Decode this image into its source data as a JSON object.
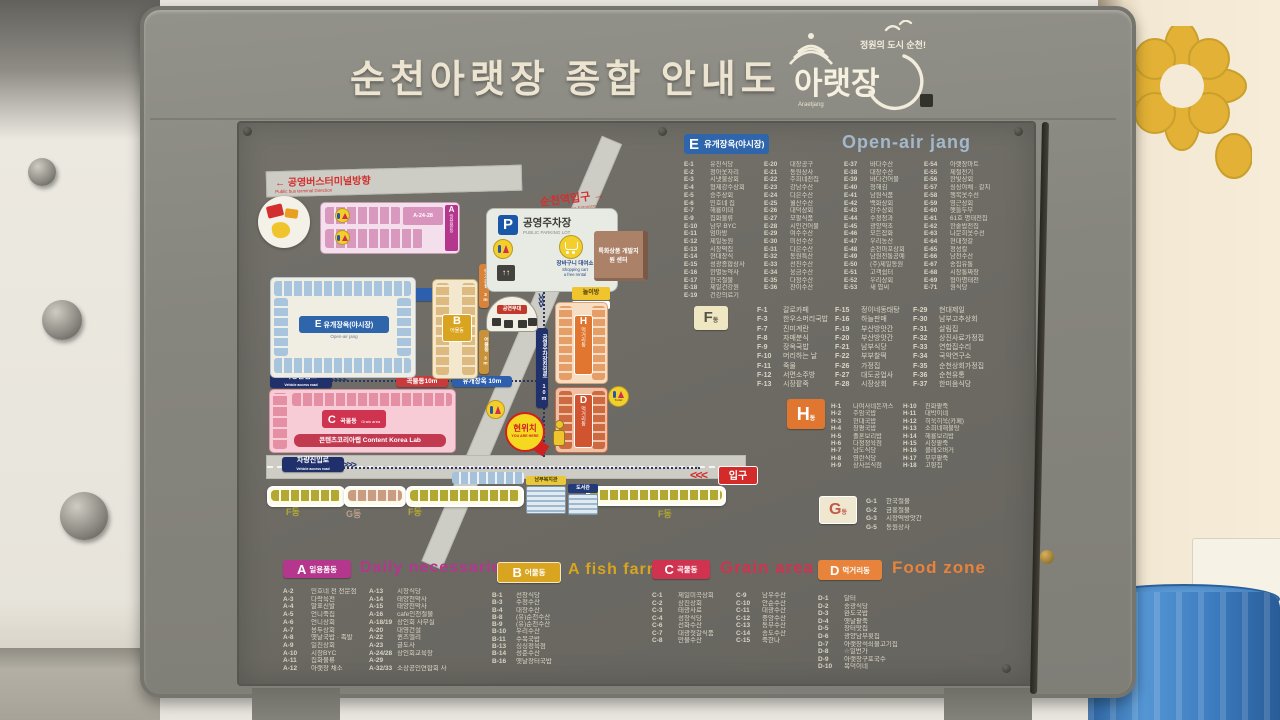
{
  "palette": {
    "board_gray": "#87867e",
    "panel_gray": "#6c6a63",
    "list_text": "#d9d4c5",
    "accent_E": "#2f66ab",
    "accent_A": "#b5368d",
    "accent_B": "#d9a520",
    "accent_C": "#cf3350",
    "accent_D": "#e8833c",
    "accent_H": "#e0762f",
    "road_gray": "#cdccc5",
    "entrance_red": "#d42a2a",
    "here_yellow": "#f5d820"
  },
  "sign": {
    "title": "순천아랫장  종합 안내도",
    "logo_tagline": "정원의 도시 순천!",
    "logo_name": "아랫장",
    "logo_latin": "Araetjang"
  },
  "legend": {
    "E": {
      "letter": "E",
      "kr": "유개장옥(야시장)",
      "en": "Open-air jang",
      "columns": [
        [
          {
            "id": "E-1",
            "name": "유진식당"
          },
          {
            "id": "E-2",
            "name": "정아옷자리"
          },
          {
            "id": "E-3",
            "name": "시냇물상회"
          },
          {
            "id": "E-4",
            "name": "형제강수상회"
          },
          {
            "id": "E-5",
            "name": "승주상회"
          },
          {
            "id": "E-6",
            "name": "민호네 집"
          },
          {
            "id": "E-7",
            "name": "해룡이대"
          },
          {
            "id": "E-9",
            "name": "집화물류"
          },
          {
            "id": "E-10",
            "name": "남부 BYC"
          },
          {
            "id": "E-11",
            "name": "엄마방"
          },
          {
            "id": "E-12",
            "name": "제일농원"
          },
          {
            "id": "E-13",
            "name": "시장떡집"
          },
          {
            "id": "E-14",
            "name": "현대장식"
          },
          {
            "id": "E-15",
            "name": "성광종합상사"
          },
          {
            "id": "E-16",
            "name": "한별농약사"
          },
          {
            "id": "E-17",
            "name": "한국철물"
          },
          {
            "id": "E-18",
            "name": "제일건강원"
          },
          {
            "id": "E-19",
            "name": "건강의료기"
          }
        ],
        [
          {
            "id": "E-20",
            "name": "대장공구"
          },
          {
            "id": "E-21",
            "name": "동원상사"
          },
          {
            "id": "E-22",
            "name": "주희네전집"
          },
          {
            "id": "E-23",
            "name": "강남수산"
          },
          {
            "id": "E-24",
            "name": "다은수산"
          },
          {
            "id": "E-25",
            "name": "월산수산"
          },
          {
            "id": "E-26",
            "name": "대덕상회"
          },
          {
            "id": "E-27",
            "name": "모팔식품"
          },
          {
            "id": "E-28",
            "name": "시인건어물"
          },
          {
            "id": "E-29",
            "name": "여수수산"
          },
          {
            "id": "E-30",
            "name": "미선수산"
          },
          {
            "id": "E-31",
            "name": "다은수산"
          },
          {
            "id": "E-32",
            "name": "동원특산"
          },
          {
            "id": "E-33",
            "name": "선진수산"
          },
          {
            "id": "E-34",
            "name": "웅금수산"
          },
          {
            "id": "E-35",
            "name": "다정수산"
          },
          {
            "id": "E-36",
            "name": "찬이수산"
          }
        ],
        [
          {
            "id": "E-37",
            "name": "바다수산"
          },
          {
            "id": "E-38",
            "name": "대장수산"
          },
          {
            "id": "E-39",
            "name": "바다건어물"
          },
          {
            "id": "E-40",
            "name": "청해김"
          },
          {
            "id": "E-41",
            "name": "남원식품"
          },
          {
            "id": "E-42",
            "name": "백화상회"
          },
          {
            "id": "E-43",
            "name": "강수상회"
          },
          {
            "id": "E-44",
            "name": "수정청과"
          },
          {
            "id": "E-45",
            "name": "광양약초"
          },
          {
            "id": "E-46",
            "name": "모든잡화"
          },
          {
            "id": "E-47",
            "name": "우리농산"
          },
          {
            "id": "E-48",
            "name": "순천마포상회"
          },
          {
            "id": "E-49",
            "name": "남원전통공예"
          },
          {
            "id": "E-50",
            "name": "(주)제일동원"
          },
          {
            "id": "E-51",
            "name": "고객쉼터"
          },
          {
            "id": "E-52",
            "name": "우리상회"
          },
          {
            "id": "E-53",
            "name": "새 엽씨"
          }
        ],
        [
          {
            "id": "E-54",
            "name": "아랫장마트"
          },
          {
            "id": "E-55",
            "name": "제철전기"
          },
          {
            "id": "E-56",
            "name": "한빛상회"
          },
          {
            "id": "E-57",
            "name": "싱싱야채 · 갈치"
          },
          {
            "id": "E-58",
            "name": "행복옷수선"
          },
          {
            "id": "E-59",
            "name": "영근상회"
          },
          {
            "id": "E-60",
            "name": "햇들두부"
          },
          {
            "id": "E-61",
            "name": "61호 명태전집"
          },
          {
            "id": "E-62",
            "name": "한솥밥전집"
          },
          {
            "id": "E-63",
            "name": "나문희옷수선"
          },
          {
            "id": "E-64",
            "name": "현대젓갈"
          },
          {
            "id": "E-65",
            "name": "정성칼"
          },
          {
            "id": "E-66",
            "name": "남천수산"
          },
          {
            "id": "E-67",
            "name": "송집유통"
          },
          {
            "id": "E-68",
            "name": "시장통짜장"
          },
          {
            "id": "E-69",
            "name": "형아명태전"
          },
          {
            "id": "E-71",
            "name": "원식당"
          }
        ]
      ]
    },
    "F": {
      "letter": "F",
      "suffix": "동",
      "columns": [
        [
          {
            "id": "F-1",
            "name": "갈로카페"
          },
          {
            "id": "F-3",
            "name": "한우소머리국밥"
          },
          {
            "id": "F-7",
            "name": "진미계란"
          },
          {
            "id": "F-8",
            "name": "자매분식"
          },
          {
            "id": "F-9",
            "name": "장옥국밥"
          },
          {
            "id": "F-10",
            "name": "머리하는 날"
          },
          {
            "id": "F-11",
            "name": "죽물"
          },
          {
            "id": "F-12",
            "name": "서면소주방"
          },
          {
            "id": "F-13",
            "name": "시장팥죽"
          }
        ],
        [
          {
            "id": "F-15",
            "name": "정이네동태탕"
          },
          {
            "id": "F-16",
            "name": "하늘판매"
          },
          {
            "id": "F-19",
            "name": "부산방앗간"
          },
          {
            "id": "F-20",
            "name": "부산방앗간"
          },
          {
            "id": "F-21",
            "name": "남부식당"
          },
          {
            "id": "F-22",
            "name": "부부찰떡"
          },
          {
            "id": "F-26",
            "name": "가정집"
          },
          {
            "id": "F-27",
            "name": "대도공업사"
          },
          {
            "id": "F-28",
            "name": "시장상회"
          }
        ],
        [
          {
            "id": "F-29",
            "name": "현대제일"
          },
          {
            "id": "F-30",
            "name": "남부고추상회"
          },
          {
            "id": "F-31",
            "name": "살림집"
          },
          {
            "id": "F-32",
            "name": "상진사료가정집"
          },
          {
            "id": "F-33",
            "name": "연합집수리"
          },
          {
            "id": "F-34",
            "name": "국악연구소"
          },
          {
            "id": "F-35",
            "name": "순천상회가정집"
          },
          {
            "id": "F-36",
            "name": "순천유통"
          },
          {
            "id": "F-37",
            "name": "한미음식당"
          }
        ]
      ]
    },
    "H": {
      "letter": "H",
      "suffix": "동",
      "columns": [
        [
          {
            "id": "H-1",
            "name": "나여사네돈까스"
          },
          {
            "id": "H-2",
            "name": "주암국밥"
          },
          {
            "id": "H-3",
            "name": "현대국밥"
          },
          {
            "id": "H-4",
            "name": "장평국밥"
          },
          {
            "id": "H-5",
            "name": "졸혼보리밥"
          },
          {
            "id": "H-6",
            "name": "다정정육점"
          },
          {
            "id": "H-7",
            "name": "남도식당"
          },
          {
            "id": "H-8",
            "name": "영란식당"
          },
          {
            "id": "H-9",
            "name": "상사음식점"
          }
        ],
        [
          {
            "id": "H-10",
            "name": "진화팥죽"
          },
          {
            "id": "H-11",
            "name": "대박이네"
          },
          {
            "id": "H-12",
            "name": "히욱히욱(카페)"
          },
          {
            "id": "H-13",
            "name": "소희네해물탕"
          },
          {
            "id": "H-14",
            "name": "해룡보리밥"
          },
          {
            "id": "H-15",
            "name": "시장팥죽"
          },
          {
            "id": "H-16",
            "name": "클레오버거"
          },
          {
            "id": "H-17",
            "name": "부부팥죽"
          },
          {
            "id": "H-18",
            "name": "고향집"
          }
        ]
      ]
    },
    "G": {
      "letter": "G",
      "suffix": "동",
      "columns": [
        [
          {
            "id": "G-1",
            "name": "한국철물"
          },
          {
            "id": "G-2",
            "name": "금홍철물"
          },
          {
            "id": "G-3",
            "name": "시장떡방앗간"
          },
          {
            "id": "G-5",
            "name": "동원상사"
          }
        ]
      ]
    },
    "A": {
      "letter": "A",
      "kr": "일용품동",
      "en": "Daily necessaries",
      "columns": [
        [
          {
            "id": "A-2",
            "name": "민호네 전 전문점"
          },
          {
            "id": "A-3",
            "name": "다락육전"
          },
          {
            "id": "A-4",
            "name": "말표신발"
          },
          {
            "id": "A-5",
            "name": "언니죽집"
          },
          {
            "id": "A-6",
            "name": "언니상회"
          },
          {
            "id": "A-7",
            "name": "용두상회"
          },
          {
            "id": "A-8",
            "name": "옛날국밥 · 족발"
          },
          {
            "id": "A-9",
            "name": "일진상회"
          },
          {
            "id": "A-10",
            "name": "시장BYC"
          },
          {
            "id": "A-11",
            "name": "집화물류"
          },
          {
            "id": "A-12",
            "name": "아랫장 채소"
          }
        ],
        [
          {
            "id": "A-13",
            "name": "시장식당"
          },
          {
            "id": "A-14",
            "name": "태양천막사"
          },
          {
            "id": "A-15",
            "name": "태양천막사"
          },
          {
            "id": "A-16",
            "name": "cafe인천철물"
          },
          {
            "id": "A-18/19",
            "name": "상인회 사무실"
          },
          {
            "id": "A-20",
            "name": "대영건설"
          },
          {
            "id": "A-22",
            "name": "퀸즈엘리"
          },
          {
            "id": "A-23",
            "name": "글도사"
          },
          {
            "id": "A-24/28",
            "name": "상인회교육장"
          },
          {
            "id": "A-29",
            "name": ""
          },
          {
            "id": "A-32/33",
            "name": "소상공인연합회 사무실"
          }
        ]
      ]
    },
    "B": {
      "letter": "B",
      "kr": "어물동",
      "en": "A fish farm",
      "columns": [
        [
          {
            "id": "B-1",
            "name": "선창식당"
          },
          {
            "id": "B-3",
            "name": "수정수산"
          },
          {
            "id": "B-4",
            "name": "대장수산"
          },
          {
            "id": "B-8",
            "name": "(유)순천수산"
          },
          {
            "id": "B-9",
            "name": "(유)순천수산"
          },
          {
            "id": "B-10",
            "name": "우리수산"
          },
          {
            "id": "B-11",
            "name": "수복국밥"
          },
          {
            "id": "B-13",
            "name": "싱싱정육점"
          },
          {
            "id": "B-14",
            "name": "성준수산"
          },
          {
            "id": "B-16",
            "name": "옛날장터국밥"
          }
        ]
      ]
    },
    "C": {
      "letter": "C",
      "kr": "곡물동",
      "en": "Grain area",
      "columns": [
        [
          {
            "id": "C-1",
            "name": "제일미곡상회"
          },
          {
            "id": "C-2",
            "name": "상진상회"
          },
          {
            "id": "C-3",
            "name": "태광사료"
          },
          {
            "id": "C-4",
            "name": "성장식당"
          },
          {
            "id": "C-6",
            "name": "선화수산"
          },
          {
            "id": "C-7",
            "name": "대광젓갈식품"
          },
          {
            "id": "C-8",
            "name": "만물수산"
          }
        ],
        [
          {
            "id": "C-9",
            "name": "남우수산"
          },
          {
            "id": "C-10",
            "name": "안순수산"
          },
          {
            "id": "C-11",
            "name": "대광수산"
          },
          {
            "id": "C-12",
            "name": "중앙수산"
          },
          {
            "id": "C-13",
            "name": "동부수산"
          },
          {
            "id": "C-14",
            "name": "송도수산"
          },
          {
            "id": "C-15",
            "name": "죽한나"
          }
        ]
      ]
    },
    "D": {
      "letter": "D",
      "kr": "먹거리동",
      "en": "Food zone",
      "columns": [
        [
          {
            "id": "D-1",
            "name": "달터"
          },
          {
            "id": "D-2",
            "name": "송광식당"
          },
          {
            "id": "D-3",
            "name": "완도국밥"
          },
          {
            "id": "D-4",
            "name": "옛날팥죽"
          },
          {
            "id": "D-5",
            "name": "장터맛집"
          },
          {
            "id": "D-6",
            "name": "광양남부횟집"
          },
          {
            "id": "D-7",
            "name": "아랫장석쇠불고기집"
          },
          {
            "id": "D-8",
            "name": "☆일번가"
          },
          {
            "id": "D-9",
            "name": "아랫장구포국수"
          },
          {
            "id": "D-10",
            "name": "복덕이네"
          }
        ]
      ]
    }
  },
  "map": {
    "bus_terminal": {
      "arrow": "←",
      "kr": "공영버스터미널방향",
      "en": "Public bus terminal Direction"
    },
    "station": {
      "kr": "순천역입구 →",
      "en": "Suncheon Station Entrance"
    },
    "roads": {
      "vehicle_kr": "차량진입로",
      "vehicle_en": "Vehicle access road",
      "open_air_8m": "유개장옥 8m",
      "open_air_8m_en": "Open-air jang",
      "grain_10m": "곡물동10m",
      "open_air_10m": "유개장옥 10m",
      "parking_access": "공영주차장진입로 10m",
      "fish_3m": "어물동 3m",
      "food_3m": "먹거리동 3m"
    },
    "parking": {
      "p": "P",
      "kr": "공영주차장",
      "en": "PUBLIC PARKING LOT"
    },
    "cart": {
      "kr": "장바구니 대여소",
      "en1": "Shopping cart",
      "en2": "a free rental"
    },
    "facilities": {
      "specialty": "특화상품 개발지원 센터",
      "playroom_kr": "놀이방",
      "playroom_en": "Playroom",
      "welfare": "남부복지관",
      "library": "도서관",
      "stage": "공연무대",
      "content_lab": "콘텐츠코리아랩  Content Korea Lab",
      "toilet": "Toilet"
    },
    "buildings": {
      "A": {
        "letter": "A",
        "kr": "일용품동",
        "block": "A-24-28"
      },
      "B": {
        "letter": "B",
        "kr": "어물동"
      },
      "C": {
        "letter": "C",
        "kr": "곡물동",
        "en": "Grain area"
      },
      "D": {
        "letter": "D",
        "kr": "먹거리동"
      },
      "E": {
        "letter": "E",
        "kr": "유개장옥(야시장)",
        "en": "Open-air jang"
      },
      "H": {
        "letter": "H",
        "kr": "먹거리동"
      },
      "F": "F동",
      "G": "G동"
    },
    "markers": {
      "here_kr": "현위치",
      "here_en": "YOU ARE HERE",
      "entrance": "입구"
    }
  }
}
